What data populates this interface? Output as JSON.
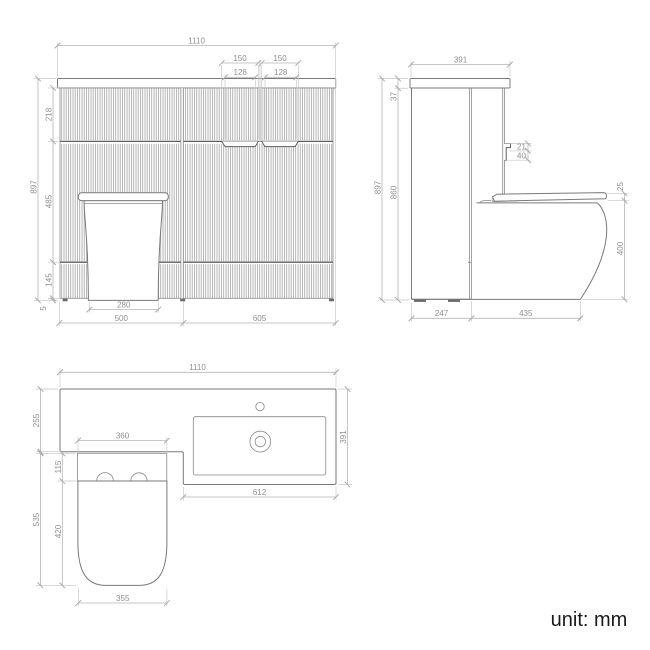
{
  "unit_label": "unit: mm",
  "dims": {
    "front": {
      "total_width": "1110",
      "handle_left_outer": "150",
      "handle_right_outer": "150",
      "handle_left_inner": "128",
      "handle_right_inner": "128",
      "total_height": "897",
      "top_drawer_height": "218",
      "middle_section_height": "485",
      "plinth_height": "145",
      "floor_gap": "5",
      "pan_base_width": "280",
      "wc_section_width": "500",
      "vanity_section_width": "605"
    },
    "side": {
      "worktop_depth": "391",
      "worktop_thickness": "37",
      "total_height": "897",
      "cabinet_height": "860",
      "handle_upper": "21",
      "handle_lower": "40",
      "seat_thickness": "25",
      "pan_height": "400",
      "cabinet_depth": "247",
      "pan_projection": "435"
    },
    "plan": {
      "total_width": "1110",
      "left_worktop_depth": "255",
      "right_worktop_depth": "391",
      "wc_unit_width": "360",
      "cistern_ledge_depth": "115",
      "wc_total_depth": "535",
      "seat_depth": "420",
      "basin_section_width": "612",
      "seat_width": "355"
    }
  }
}
